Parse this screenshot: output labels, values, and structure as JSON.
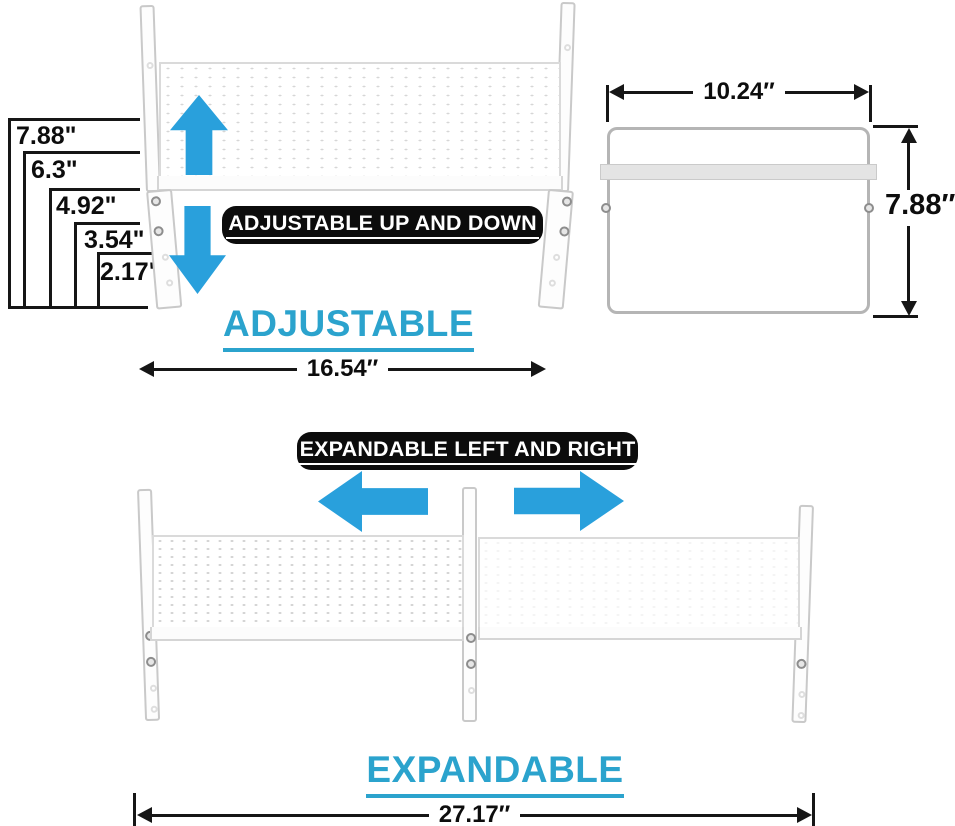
{
  "colors": {
    "arrow_blue": "#29a0dc",
    "heading_cyan": "#2ba3cd",
    "pill_bg": "#0c0c0c",
    "pill_text": "#ffffff",
    "dim_black": "#161616"
  },
  "adjustable_section": {
    "height_measurements": [
      "7.88\"",
      "6.3\"",
      "4.92\"",
      "3.54\"",
      "2.17\""
    ],
    "callout": "ADJUSTABLE UP AND DOWN",
    "heading": "ADJUSTABLE",
    "width_measurement": "16.54″"
  },
  "side_view": {
    "width_measurement": "10.24″",
    "height_measurement": "7.88″"
  },
  "expandable_section": {
    "callout": "EXPANDABLE LEFT AND RIGHT",
    "heading": "EXPANDABLE",
    "width_measurement": "27.17″"
  }
}
